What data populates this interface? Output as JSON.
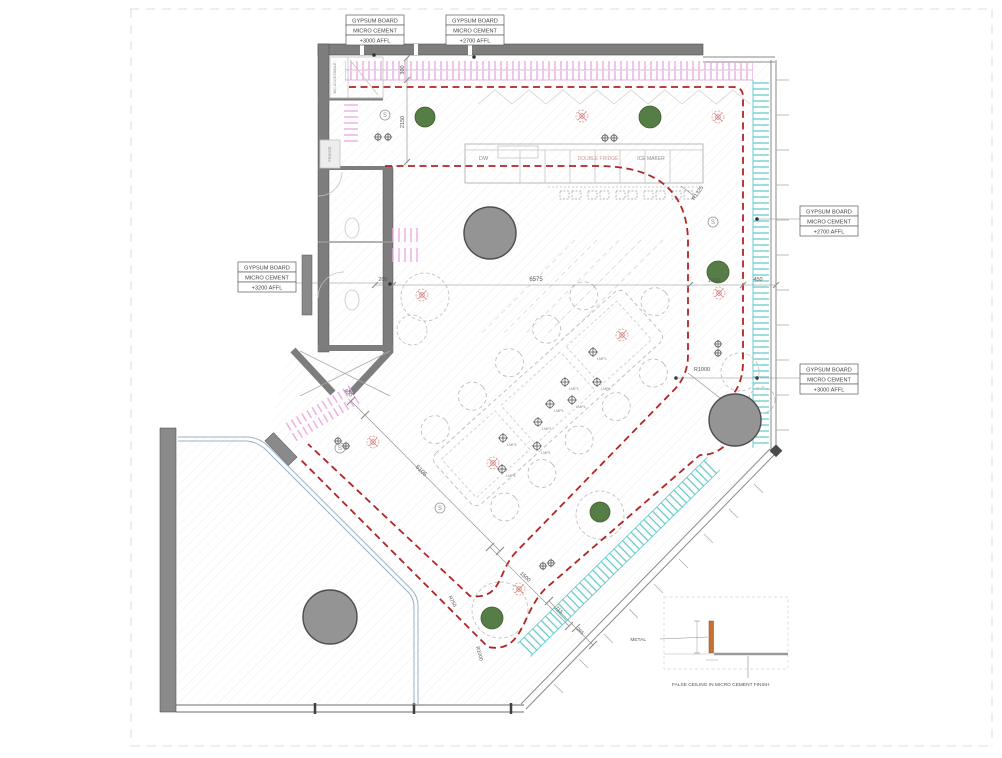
{
  "colors": {
    "red_dash": "#b32424",
    "pink_hatch": "#e7a6de",
    "cyan_hatch": "#5ec7c7",
    "green_dot": "#567d46",
    "wall_gray": "#7d7d7d",
    "column_gray": "#949494",
    "metal_orange": "#c87137",
    "glazing_blue": "#9bb3c4"
  },
  "ceiling_labels": [
    {
      "id": "top-left",
      "lines": [
        "GYPSUM BOARD",
        "MICRO CEMENT",
        "+3000 AFFL"
      ]
    },
    {
      "id": "top-center",
      "lines": [
        "GYPSUM BOARD",
        "MICRO CEMENT",
        "+2700 AFFL"
      ]
    },
    {
      "id": "right-upper",
      "lines": [
        "GYPSUM BOARD",
        "MICRO CEMENT",
        "+2700 AFFL"
      ]
    },
    {
      "id": "right-lower",
      "lines": [
        "GYPSUM BOARD",
        "MICRO CEMENT",
        "+3000 AFFL"
      ]
    },
    {
      "id": "left",
      "lines": [
        "GYPSUM BOARD",
        "MICRO CEMENT",
        "+3200 AFFL"
      ]
    }
  ],
  "equipment": {
    "dw": "DW",
    "double_fridge": "DOUBLE FRIDGE",
    "ice_maker": "ICE MAKER"
  },
  "rooms": {
    "store": "WC ACCESSIBLE",
    "fridge": "FRIDGE"
  },
  "dims": {
    "t300": "300",
    "v2150": "2150",
    "w200": "200",
    "w6575": "6575",
    "w1600": "1600",
    "w450": "450",
    "d400": "400",
    "d5105": "5105",
    "d1500": "1500",
    "d715": "715",
    "d265": "265"
  },
  "radii": {
    "counter": "R1325",
    "column": "R1000",
    "u_inner": "R750",
    "u_outer": "R1000"
  },
  "symbols": {
    "s": "S"
  },
  "lamp": "LMP1",
  "detail": {
    "metal": "METAL",
    "caption": "FALSE CEILING IN MICRO CEMENT FINISH"
  }
}
